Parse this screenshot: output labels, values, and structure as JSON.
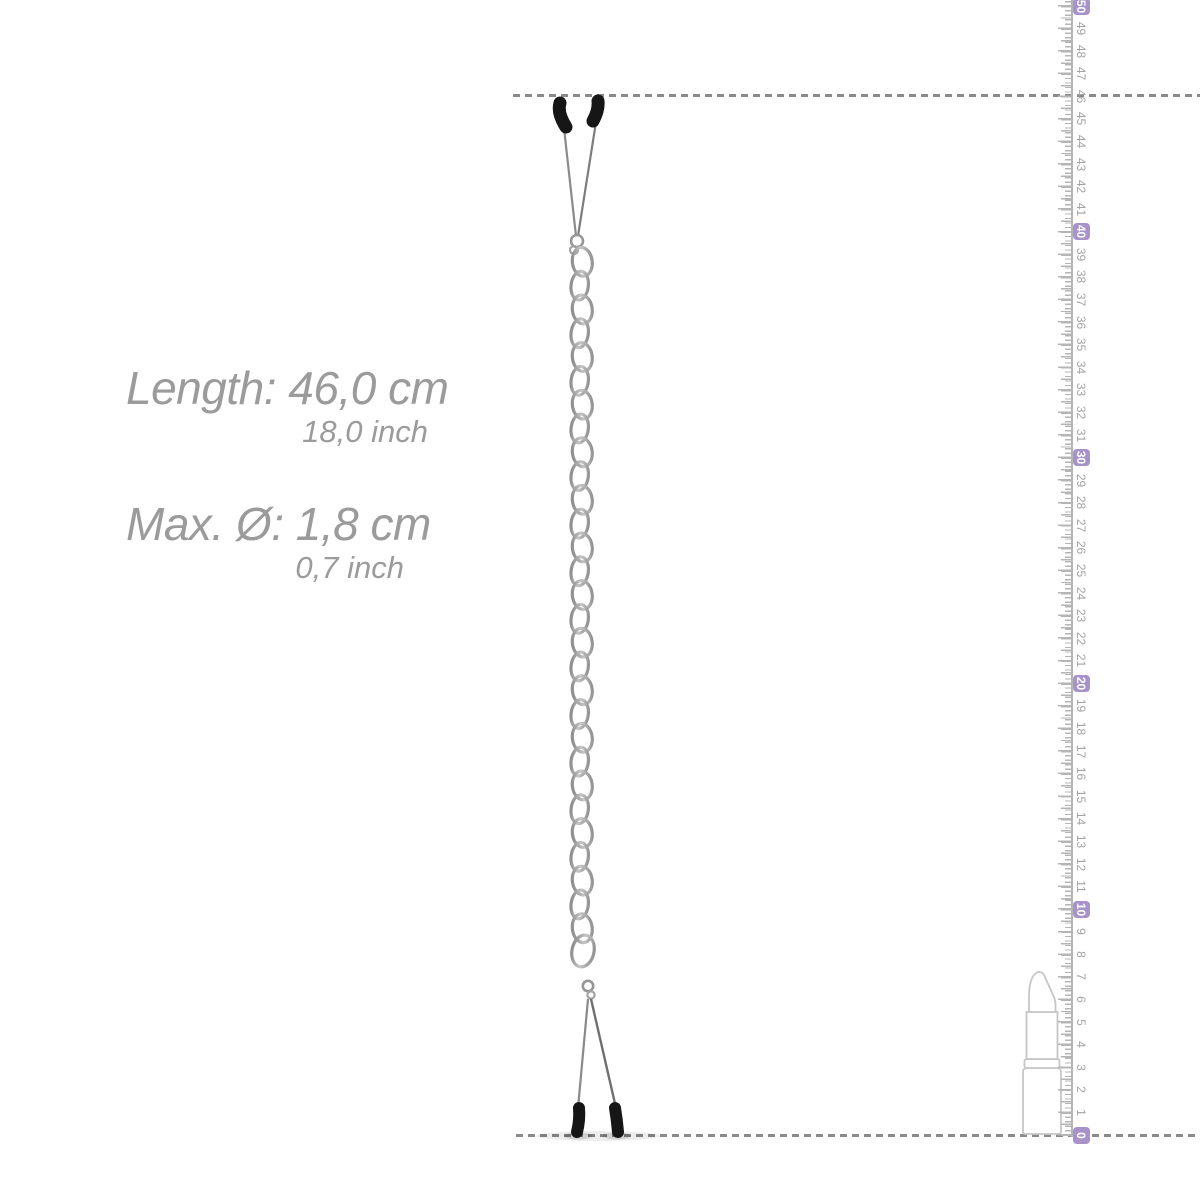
{
  "page": {
    "background": "#ffffff",
    "description": "product measurement illustration"
  },
  "specs": {
    "text_color": "#9b9b9b",
    "length": {
      "label": "Length: 46,0 cm",
      "secondary": "18,0 inch"
    },
    "diameter": {
      "label": "Max. Ø: 1,8 cm",
      "secondary": "0,7 inch"
    }
  },
  "guides": {
    "dash_color": "#8a8a8a",
    "top_value_cm": 46,
    "bottom_value_cm": 0
  },
  "ruler": {
    "unit": "cm",
    "min": 0,
    "max": 50,
    "numbers": [
      0,
      1,
      2,
      3,
      4,
      5,
      6,
      7,
      8,
      9,
      10,
      11,
      12,
      13,
      14,
      15,
      16,
      17,
      18,
      19,
      20,
      21,
      22,
      23,
      24,
      25,
      26,
      27,
      28,
      29,
      30,
      31,
      32,
      33,
      34,
      35,
      36,
      37,
      38,
      39,
      40,
      41,
      42,
      43,
      44,
      45,
      46,
      47,
      48,
      49,
      50
    ],
    "highlighted": [
      0,
      10,
      20,
      30,
      40,
      50
    ],
    "number_color": "#a3a3a3",
    "tick_color": "#b5b5b5",
    "badge_bg": "#a792c9",
    "badge_text": "#ffffff"
  },
  "product": {
    "type": "tweezer clamps joined by metal chain",
    "tip_color": "#161616",
    "arm_color": "#8a8a8a",
    "chain_color": "#9e9e9e",
    "chain_link_count": 29
  },
  "scale_reference": {
    "object": "lipstick",
    "outline_color": "#c6c6c6"
  }
}
